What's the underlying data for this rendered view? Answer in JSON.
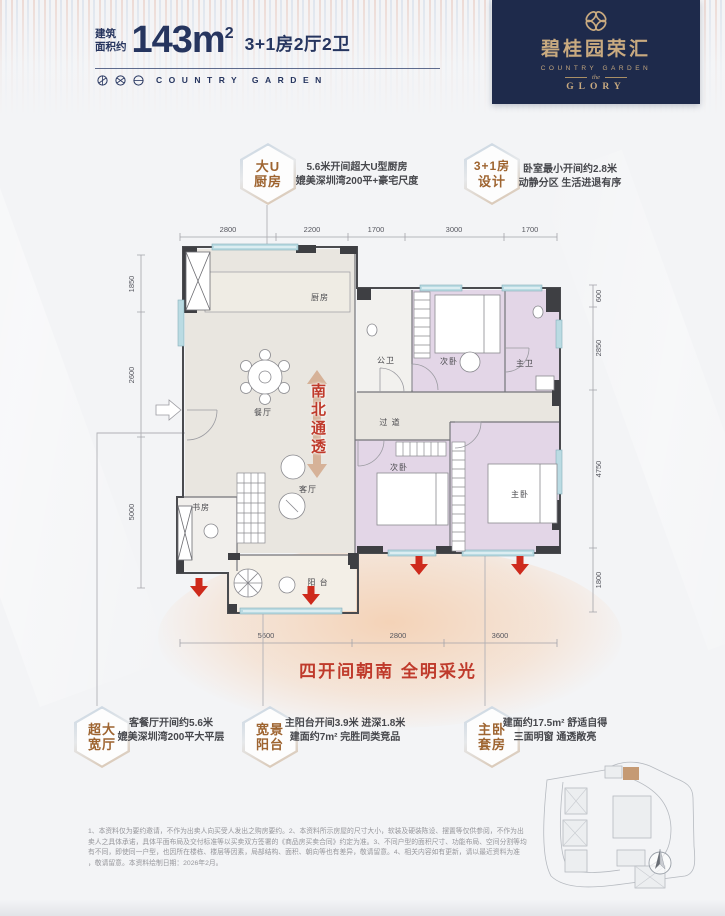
{
  "header": {
    "area_label_l1": "建筑",
    "area_label_l2": "面积约",
    "area_value": "143m",
    "area_sup": "2",
    "spec": "3+1房2厅2卫",
    "brand_en": "COUNTRY GARDEN"
  },
  "logo": {
    "cn": "碧桂园荣汇",
    "en": "COUNTRY GARDEN",
    "mid": "the",
    "sub": "GLORY"
  },
  "badges": [
    {
      "l1": "大U",
      "l2": "厨房",
      "d1": "5.6米开间超大U型厨房",
      "d2": "媲美深圳湾200平+豪宅尺度"
    },
    {
      "l1": "3+1房",
      "l2": "设计",
      "d1": "卧室最小开间约2.8米",
      "d2": "动静分区 生活进退有序"
    },
    {
      "l1": "超大",
      "l2": "宽厅",
      "d1": "客餐厅开间约5.6米",
      "d2": "媲美深圳湾200平大平层"
    },
    {
      "l1": "宽景",
      "l2": "阳台",
      "d1": "主阳台开间3.9米 进深1.8米",
      "d2": "建面约7m² 完胜同类竞品"
    },
    {
      "l1": "主卧",
      "l2": "套房",
      "d1": "建面约17.5m² 舒适自得",
      "d2": "三面明窗 通透敞亮"
    }
  ],
  "plan": {
    "rooms": {
      "kitchen": "厨房",
      "dining": "餐厅",
      "living": "客厅",
      "study": "书房",
      "balcony": "阳 台",
      "hallway": "过 道",
      "bath_public": "公卫",
      "bath_master": "主卫",
      "bedroom2a": "次卧",
      "bedroom2b": "次卧",
      "bedroom_master": "主卧"
    },
    "ns_label": "南北通透",
    "dims_top": [
      "2800",
      "2200",
      "1700",
      "3000",
      "1700"
    ],
    "dims_left": [
      "1850",
      "2600",
      "5000"
    ],
    "dims_right": [
      "600",
      "2850",
      "4750",
      "1800"
    ],
    "dims_bottom": [
      "5600",
      "2800",
      "3600"
    ]
  },
  "highlight": "四开间朝南 全明采光",
  "disclaimer": [
    "1、本资料仅为要约邀请，不作为出卖人向买受人发出之购房要约。2、本资料所示房屋的尺寸大小，软装及硬装陈设、摆置等仅供参阅，不作为出",
    "卖人之具体承诺，具体平面布局及交付标准等以买卖双方签署的《商品房买卖合同》约定为准。3、不同户型的面积尺寸、功能布局、空间分割等均",
    "有不同，即使同一户型，也因所在楼栋、楼层等因素，局部结构、面积、朝向等也有差异，敬请留意。4、相关内容如有更新，请以最近资料为准",
    "，敬请留意。本资料绘制日期：2026年2月。"
  ],
  "colors": {
    "navy": "#26355f",
    "gold": "#c9aa80",
    "red": "#bf3a2b",
    "badge_brown": "#9e6430",
    "lavender": "#e3d6e7",
    "beige": "#e9e6e0",
    "window_blue": "#badbe3",
    "arrow_red": "#ce2a1c",
    "arrow_tan": "#d2a88b"
  }
}
